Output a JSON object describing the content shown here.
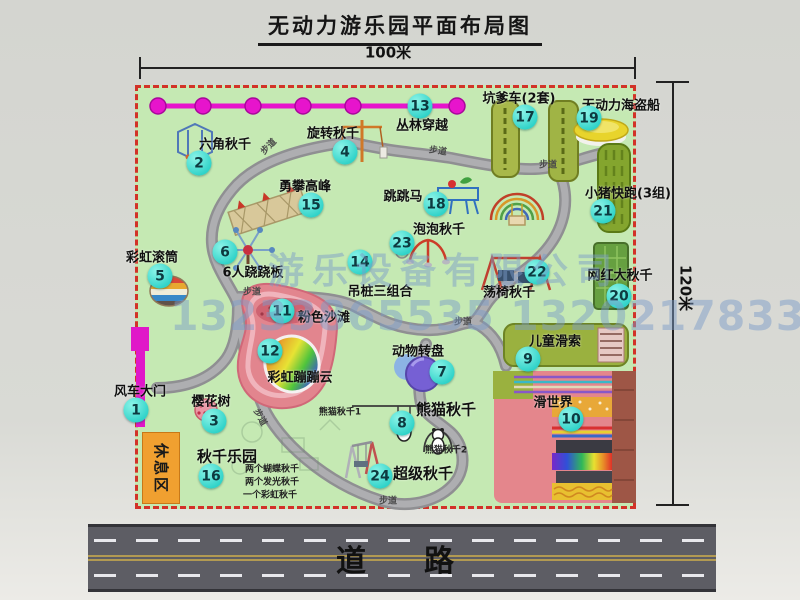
{
  "title": "无动力游乐园平面布局图",
  "dimensions": {
    "top": "100米",
    "right": "120米"
  },
  "road": {
    "label": "道　路"
  },
  "rest_area": {
    "label": "休息区"
  },
  "watermark": {
    "company": "游乐设备有限公司",
    "phone": "13233865535 13202178333"
  },
  "colors": {
    "map_green": "#c5e9b3",
    "border_red": "#d23228",
    "badge_cyan": "#2ed2c8",
    "zipline_magenta": "#e714cc",
    "gate_magenta": "#e018c8",
    "rest_orange": "#f0a030",
    "road_gray": "#5d5d64",
    "watermark_blue": "#7c9cc8"
  },
  "attractions": [
    {
      "num": "1",
      "label": "风车大门",
      "lx": 140,
      "ly": 390,
      "bx": 136,
      "by": 410
    },
    {
      "num": "2",
      "label": "六角秋千",
      "lx": 225,
      "ly": 143,
      "bx": 199,
      "by": 163
    },
    {
      "num": "3",
      "label": "樱花树",
      "lx": 211,
      "ly": 400,
      "bx": 214,
      "by": 421
    },
    {
      "num": "4",
      "label": "旋转秋千",
      "lx": 333,
      "ly": 132,
      "bx": 345,
      "by": 152
    },
    {
      "num": "5",
      "label": "彩虹滚筒",
      "lx": 152,
      "ly": 256,
      "bx": 160,
      "by": 276
    },
    {
      "num": "6",
      "label": "6人跷跷板",
      "lx": 253,
      "ly": 271,
      "bx": 225,
      "by": 252
    },
    {
      "num": "7",
      "label": "动物转盘",
      "lx": 418,
      "ly": 350,
      "bx": 442,
      "by": 372
    },
    {
      "num": "8",
      "label": "熊猫秋千",
      "lx": 446,
      "ly": 409,
      "bx": 402,
      "by": 423,
      "ls": 15,
      "subs": [
        {
          "t": "熊猫秋千1",
          "x": 340,
          "y": 411
        },
        {
          "t": "熊猫秋千2",
          "x": 446,
          "y": 449
        }
      ]
    },
    {
      "num": "9",
      "label": "儿童滑索",
      "lx": 555,
      "ly": 340,
      "bx": 528,
      "by": 359
    },
    {
      "num": "10",
      "label": "滑世界",
      "lx": 553,
      "ly": 401,
      "bx": 571,
      "by": 419
    },
    {
      "num": "11",
      "label": "粉色沙滩",
      "lx": 324,
      "ly": 316,
      "bx": 282,
      "by": 311
    },
    {
      "num": "12",
      "label": "彩虹蹦蹦云",
      "lx": 300,
      "ly": 376,
      "bx": 270,
      "by": 351
    },
    {
      "num": "13",
      "label": "丛林穿越",
      "lx": 422,
      "ly": 124,
      "bx": 420,
      "by": 106
    },
    {
      "num": "14",
      "label": "吊桩三组合",
      "lx": 380,
      "ly": 290,
      "bx": 360,
      "by": 262
    },
    {
      "num": "15",
      "label": "勇攀高峰",
      "lx": 305,
      "ly": 185,
      "bx": 311,
      "by": 205
    },
    {
      "num": "16",
      "label": "秋千乐园",
      "lx": 227,
      "ly": 456,
      "bx": 211,
      "by": 476,
      "ls": 15,
      "subs": [
        {
          "t": "两个蝴蝶秋千",
          "x": 272,
          "y": 468
        },
        {
          "t": "两个发光秋千",
          "x": 272,
          "y": 481
        },
        {
          "t": "一个彩虹秋千",
          "x": 270,
          "y": 494
        }
      ]
    },
    {
      "num": "17",
      "label": "坑爹车(2套)",
      "lx": 519,
      "ly": 97,
      "bx": 525,
      "by": 117
    },
    {
      "num": "18",
      "label": "跳跳马",
      "lx": 403,
      "ly": 195,
      "bx": 436,
      "by": 204
    },
    {
      "num": "19",
      "label": "无动力海盗船",
      "lx": 621,
      "ly": 104,
      "bx": 589,
      "by": 118
    },
    {
      "num": "20",
      "label": "网红大秋千",
      "lx": 620,
      "ly": 274,
      "bx": 619,
      "by": 296
    },
    {
      "num": "21",
      "label": "小猪快跑(3组)",
      "lx": 628,
      "ly": 192,
      "bx": 603,
      "by": 211
    },
    {
      "num": "22",
      "label": "荡椅秋千",
      "lx": 509,
      "ly": 291,
      "bx": 537,
      "by": 272
    },
    {
      "num": "23",
      "label": "泡泡秋千",
      "lx": 439,
      "ly": 228,
      "bx": 402,
      "by": 243
    },
    {
      "num": "24",
      "label": "超级秋千",
      "lx": 423,
      "ly": 473,
      "bx": 380,
      "by": 476,
      "ls": 15
    }
  ],
  "path_labels": [
    {
      "t": "步道",
      "x": 268,
      "y": 146,
      "r": -45
    },
    {
      "t": "步道",
      "x": 438,
      "y": 150,
      "r": 8
    },
    {
      "t": "步道",
      "x": 548,
      "y": 164,
      "r": 0
    },
    {
      "t": "步道",
      "x": 252,
      "y": 291,
      "r": 0
    },
    {
      "t": "步道",
      "x": 463,
      "y": 321,
      "r": 0
    },
    {
      "t": "步道",
      "x": 388,
      "y": 500,
      "r": 0
    },
    {
      "t": "步道",
      "x": 261,
      "y": 417,
      "r": 62
    }
  ]
}
